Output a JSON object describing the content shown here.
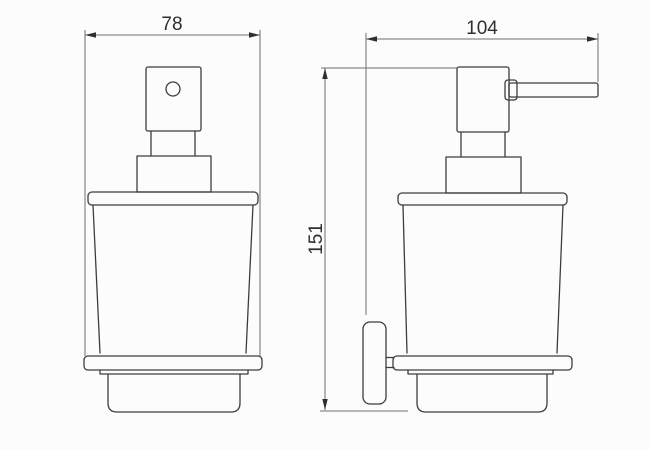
{
  "drawing": {
    "subject": "soap-dispenser-technical-drawing",
    "dimensions": {
      "width": "78",
      "depth": "104",
      "height": "151"
    },
    "colors": {
      "background": "#fcfcfc",
      "object_line": "#3d3d3d",
      "dimension_line": "#6e6e6e",
      "arrow": "#2f2f2f",
      "text": "#2f2f2f"
    }
  }
}
